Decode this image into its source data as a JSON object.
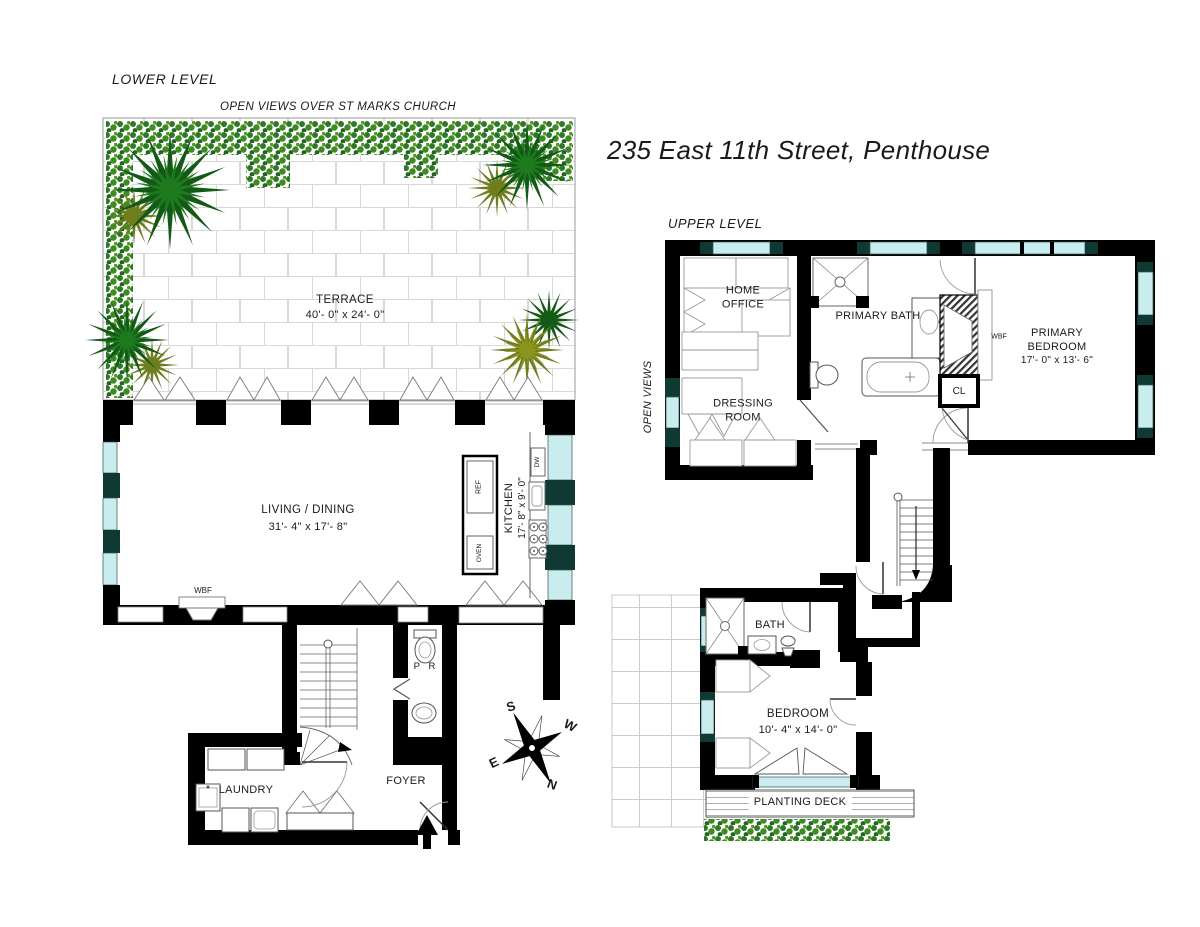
{
  "title": "235 East 11th Street, Penthouse",
  "lower_level": {
    "label": "LOWER LEVEL",
    "view_note": "OPEN VIEWS OVER ST MARKS CHURCH",
    "rooms": {
      "terrace": {
        "name": "TERRACE",
        "dims": "40'- 0\" x 24'- 0\""
      },
      "living_dining": {
        "name": "LIVING / DINING",
        "dims": "31'- 4\" x 17'- 8\""
      },
      "kitchen": {
        "name": "KITCHEN",
        "dims": "17'- 8\" x 9'- 0\""
      },
      "powder_room": {
        "name": "P R"
      },
      "laundry": {
        "name": "LAUNDRY"
      },
      "foyer": {
        "name": "FOYER"
      }
    },
    "fixtures": {
      "ref": "REF",
      "oven": "OVEN",
      "dw": "DW",
      "wbf": "WBF"
    }
  },
  "upper_level": {
    "label": "UPPER LEVEL",
    "view_note": "OPEN VIEWS",
    "rooms": {
      "home_office": {
        "line1": "HOME",
        "line2": "OFFICE"
      },
      "dressing_room": {
        "line1": "DRESSING",
        "line2": "ROOM"
      },
      "primary_bath": {
        "name": "PRIMARY BATH"
      },
      "primary_bedroom": {
        "line1": "PRIMARY",
        "line2": "BEDROOM",
        "dims": "17'- 0\" x 13'- 6\""
      },
      "bath": {
        "name": "BATH"
      },
      "bedroom": {
        "name": "BEDROOM",
        "dims": "10'- 4\" x 14'- 0\""
      },
      "closet": {
        "name": "CL"
      },
      "planting_deck": {
        "name": "PLANTING DECK"
      }
    },
    "fixtures": {
      "wbf": "WBF"
    }
  },
  "compass": {
    "n": "N",
    "s": "S",
    "e": "E",
    "w": "W"
  },
  "colors": {
    "wall": "#000000",
    "window": "#c9ecef",
    "window_frame": "#0e3a33",
    "plant_dark": "#135a17",
    "plant_olive": "#6f7d1d",
    "hedge_green": "#2c7a28"
  }
}
